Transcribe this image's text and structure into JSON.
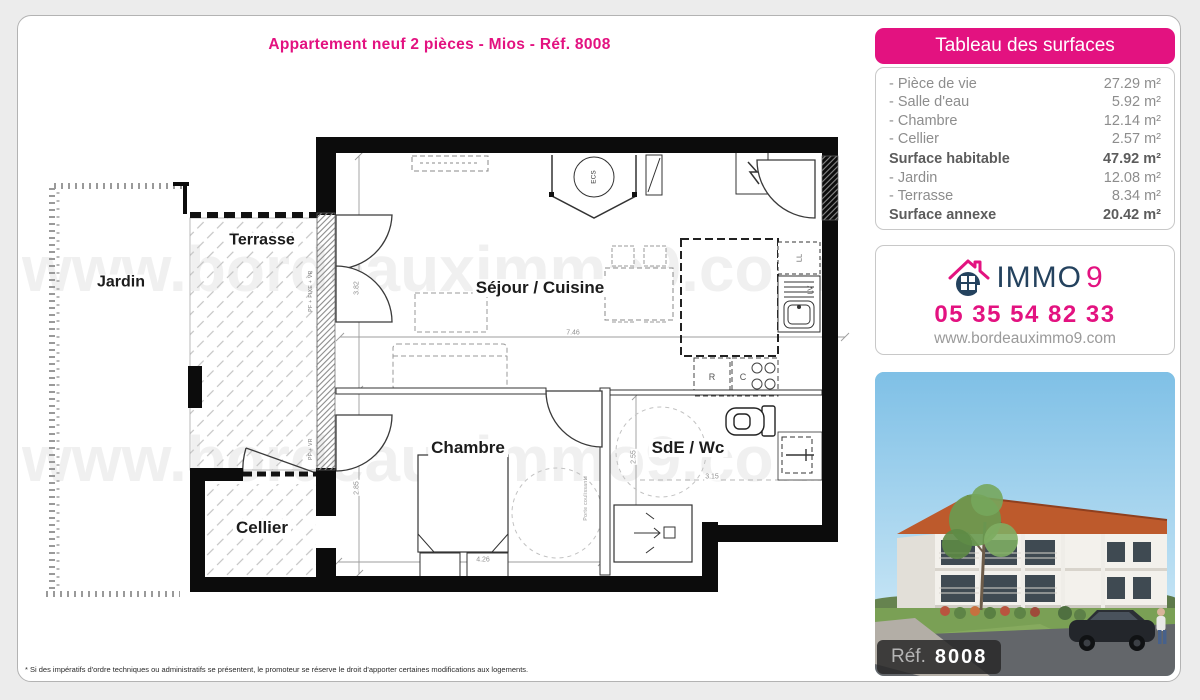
{
  "title": "Appartement neuf 2 pièces - Mios - Réf. 8008",
  "surfaces": {
    "header": "Tableau des surfaces",
    "rows": [
      {
        "label": "- Pièce de vie",
        "value": "27.29 m²"
      },
      {
        "label": "- Salle d'eau",
        "value": "5.92 m²"
      },
      {
        "label": "- Chambre",
        "value": "12.14 m²"
      },
      {
        "label": "- Cellier",
        "value": "2.57 m²"
      },
      {
        "label": "Surface habitable",
        "value": "47.92 m²"
      },
      {
        "label": "- Jardin",
        "value": "12.08 m²"
      },
      {
        "label": "- Terrasse",
        "value": "8.34 m²"
      },
      {
        "label": "Surface annexe",
        "value": "20.42 m²"
      }
    ]
  },
  "agency": {
    "brand_text": "IMMO",
    "brand_digit": "9",
    "phone": "05 35 54 82 33",
    "website": "www.bordeauximmo9.com"
  },
  "photo": {
    "ref_label": "Réf.",
    "ref_number": "8008"
  },
  "plan": {
    "rooms": {
      "terrasse": "Terrasse",
      "jardin": "Jardin",
      "sejour": "Séjour / Cuisine",
      "chambre": "Chambre",
      "sde": "SdE / Wc",
      "cellier": "Cellier"
    },
    "dims": {
      "d382": "3.82",
      "d285": "2.85",
      "d746": "7.46",
      "d426": "4.26",
      "d255": "2.55",
      "d315": "3.15"
    },
    "notes": {
      "ecs": "ECS",
      "ll": "LL",
      "lv": "LV",
      "r": "R",
      "c": "C",
      "pf_fixe": "PF + FIXE + VR",
      "pf": "PF + VR",
      "sliding": "Porte coulissante"
    }
  },
  "watermark": "www.bordeauximmo9.com",
  "disclaimer": "* Si des impératifs d'ordre techniques ou administratifs se présentent, le promoteur se réserve le droit d'apporter certaines modifications aux logements.",
  "colors": {
    "accent_pink": "#e31280",
    "brand_navy": "#24425e"
  }
}
